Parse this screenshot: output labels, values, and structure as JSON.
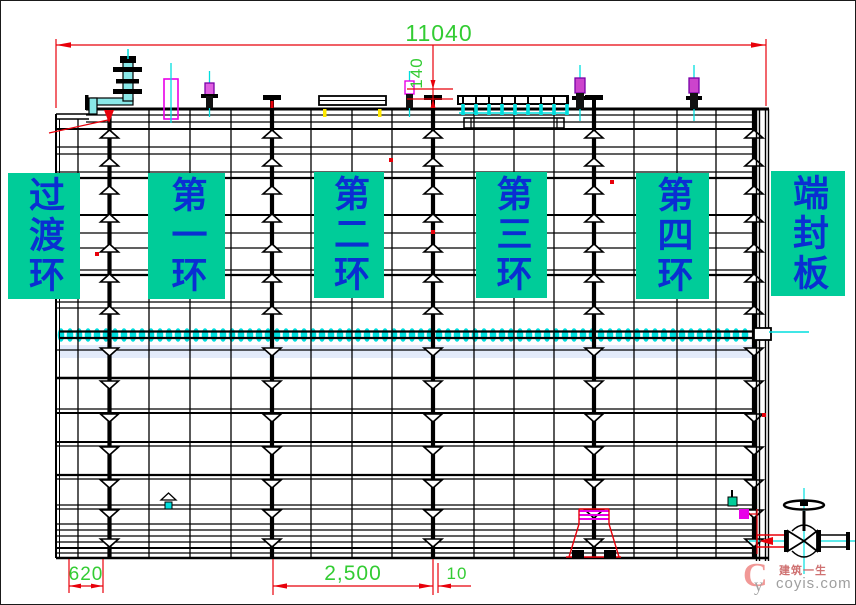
{
  "dimensions": {
    "overall_length": "11040",
    "top_offset": "140",
    "transition_ring_width": "620",
    "ring_width": "2,500",
    "ring_gap": "10"
  },
  "labels": {
    "transition_ring": "过渡环",
    "ring1": "第一环",
    "ring2": "第二环",
    "ring3": "第三环",
    "ring4": "第四环",
    "end_plate": "端封板"
  },
  "watermark": {
    "logo_main": "C",
    "logo_sub": "y",
    "brand": "建筑一生",
    "site": "coyis.com"
  },
  "colors": {
    "line": "#000000",
    "dim_line": "#e8000a",
    "dim_text": "#33cc33",
    "highlight_box": "#00cc99",
    "label_text": "#0a2fd2",
    "centerline_cyan": "#00dede",
    "accent_magenta": "#e800e8",
    "accent_yellow": "#ffe900",
    "ghost_band": "#e3ebfa"
  }
}
